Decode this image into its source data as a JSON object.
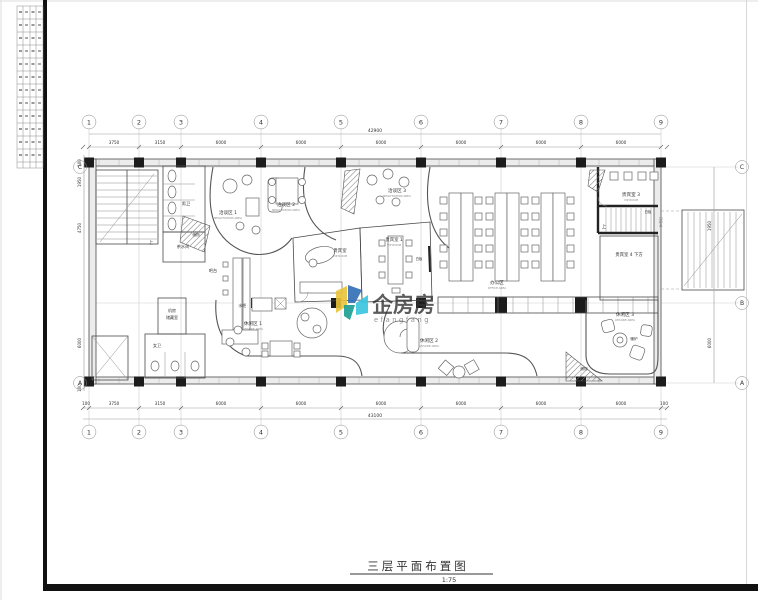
{
  "sheet": {
    "title": "三层平面布置图",
    "scale": "1:75"
  },
  "watermark": {
    "brand": "企房房",
    "sub": "efangfang",
    "color": "#e2514a",
    "logo_colors": [
      "#e8c33a",
      "#2f6db5",
      "#35c4de",
      "#1a9d92"
    ]
  },
  "grid": {
    "cols": [
      "1",
      "2",
      "3",
      "4",
      "5",
      "6",
      "7",
      "8",
      "9"
    ],
    "rows": [
      "C",
      "B",
      "A"
    ]
  },
  "dims": {
    "top_total": "42900",
    "top": [
      "3750",
      "3150",
      "6000",
      "6000",
      "6000",
      "6000",
      "6000",
      "6000"
    ],
    "bottom": [
      "100",
      "3750",
      "3150",
      "6000",
      "6000",
      "6000",
      "6000",
      "6000",
      "6000",
      "100"
    ],
    "bottom_total": "43100",
    "left": [
      "100",
      "1950",
      "4750",
      "6000",
      "100"
    ],
    "right": [
      "1950",
      "6000"
    ]
  },
  "labels": {
    "male_wc": "男卫",
    "tea": "茶水间",
    "female_wc": "女卫",
    "machine": "机房",
    "storage_room": "储藏室",
    "storage_a": "储物",
    "storage_b": "储物",
    "neg1": "洽谈区 1",
    "neg1_en": "NEGOTIATION AREA",
    "neg2": "洽谈区 2",
    "neg2_en": "NEGOTIATION AREA",
    "neg3": "洽谈区 3",
    "neg3_en": "NEGOTIATION AREA",
    "vip": "贵宾室",
    "vip_en": "VIP ROOM",
    "vip1": "贵宾室 1",
    "vip1_en": "VIP ROOM",
    "vip3": "贵宾室 3",
    "vip3_en": "VIP ROOM",
    "vip4_below": "贵宾室 4 下方",
    "board1": "白板",
    "board2": "白板",
    "office": "办公区",
    "office_en": "OFFICE AREA",
    "leisure1": "休闲区 1",
    "leisure1_en": "LEISURE AREA",
    "leisure2": "休闲区 2",
    "leisure2_en": "LEISURE AREA",
    "leisure3": "休闲区 3",
    "leisure3_en": "LEISURE AREA",
    "rest": "休憩区",
    "fireplace": "暖炉",
    "bar": "吧台",
    "water_bar": "水吧",
    "up1": "上",
    "up2": "上"
  }
}
